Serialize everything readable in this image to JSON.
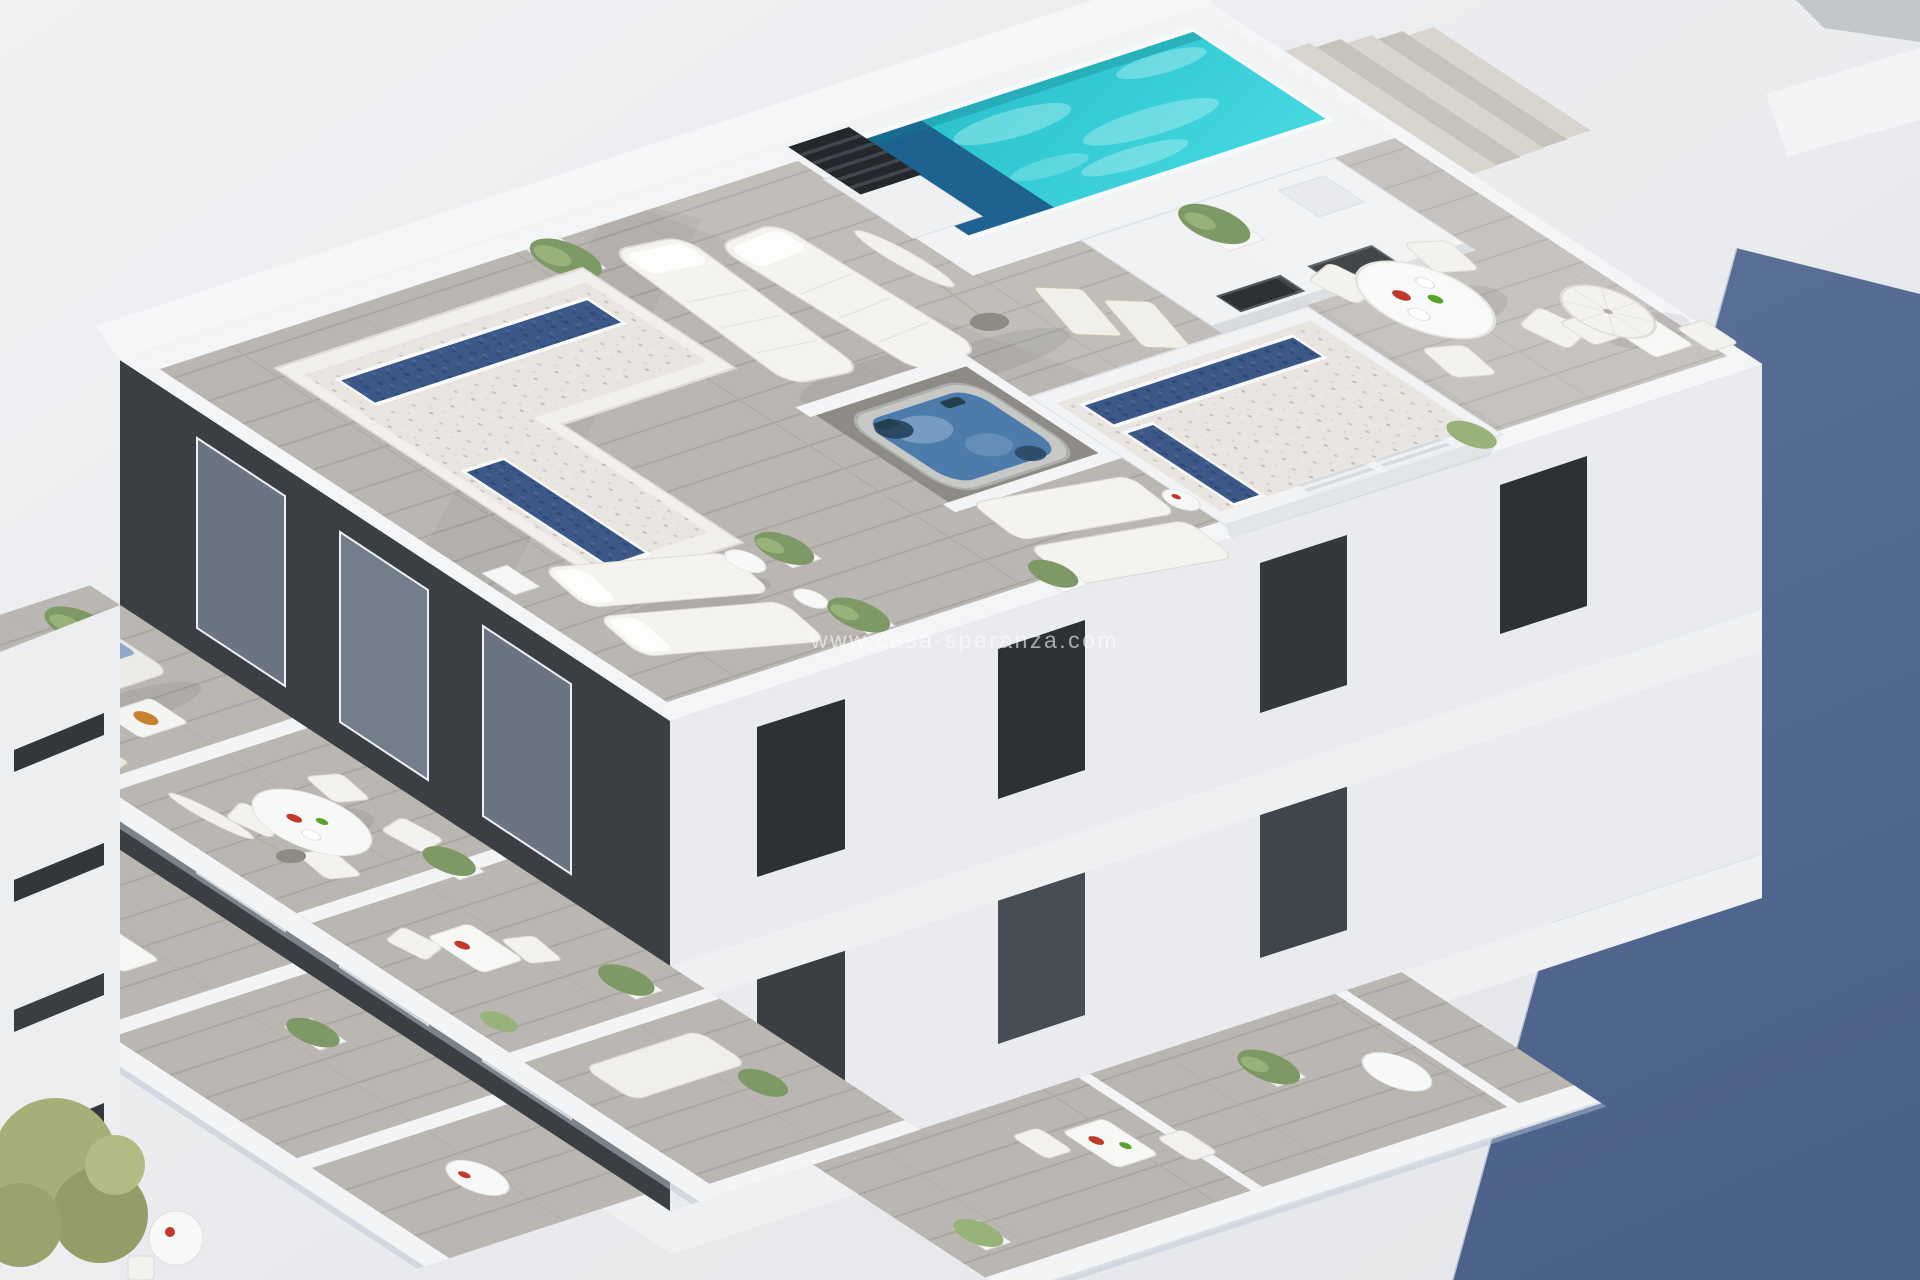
{
  "meta": {
    "type": "architectural-3d-render",
    "description": "Bird's-eye CGI render of a white minimalist apartment building rooftop solarium: turquoise pool with steps, louvered chimney, gravel roofs with linear blue skylights, timber-deck terraces with sun loungers and parasols, a sunken jacuzzi, and planted balconies with lounge and dining furniture on the floors below. A large slate-blue wall face fills the right edge.",
    "style": "white minimalist CGI visualization, soft daylight"
  },
  "watermark": {
    "text": "www.casa-speranza.com"
  },
  "colors": {
    "background": "#e9eaec",
    "shadow_wall_light": "#5a7097",
    "shadow_wall": "#4c618a",
    "deck_wood": "#bab6b1",
    "deck_wood_line": "#a9a5a0",
    "walkway_light": "#ccc9c3",
    "white_wall": "#f3f5f7",
    "wall_shade": "#e0e3e7",
    "gravel": "#e9e6e1",
    "gravel_dot": "#cfcbc4",
    "skylight_blue": "#3c5886",
    "skylight_dark": "#2e4a76",
    "pool_turquoise": "#27bfca",
    "pool_turquoise_light": "#45d9e0",
    "pool_deep_navy": "#1c5a8a",
    "charcoal_wall": "#3b3f43",
    "glass_door": "#6b7582",
    "dark_window": "#2d3135",
    "jacuzzi_shell": "#c7c9c7",
    "jacuzzi_water": "#4d7cab",
    "plant_green": "#7d9a66",
    "plant_light": "#97b379",
    "tree_olive": "#a8ae78",
    "cushion_blue": "#8fabc8",
    "lounger_white": "#f4f3f0",
    "fruit_red": "#c0392b",
    "fruit_green": "#58a32e",
    "fruit_bowl": "#c8812f",
    "chimney_dark": "#24282c",
    "step_tread": "#c6c3bd"
  },
  "objects": [
    {
      "name": "swimming-pool",
      "label": "rooftop swimming pool with dark deep end"
    },
    {
      "name": "pool-steps",
      "label": "timber access steps beside the pool"
    },
    {
      "name": "ventilation-chimney",
      "label": "dark louvered chimney"
    },
    {
      "name": "gravel-roofs",
      "label": "white gravel roof decks with blue linear skylights",
      "count": 2
    },
    {
      "name": "jacuzzi",
      "label": "sunken hot tub with blue water"
    },
    {
      "name": "sun-loungers",
      "label": "white cushioned sun loungers",
      "count": 8
    },
    {
      "name": "parasols",
      "label": "white parasols (closed and open)",
      "count": 3
    },
    {
      "name": "dining-sets",
      "label": "white outdoor tables with chairs",
      "count": 4
    },
    {
      "name": "sofa-set",
      "label": "balcony lounge sofa with blue cushions"
    },
    {
      "name": "planters",
      "label": "white planters with green shrubs",
      "count": 10
    },
    {
      "name": "balconies",
      "label": "lower-floor balconies with glass balustrades",
      "count": 6
    },
    {
      "name": "shadow-wall",
      "label": "slate-blue neighbouring wall face"
    }
  ]
}
